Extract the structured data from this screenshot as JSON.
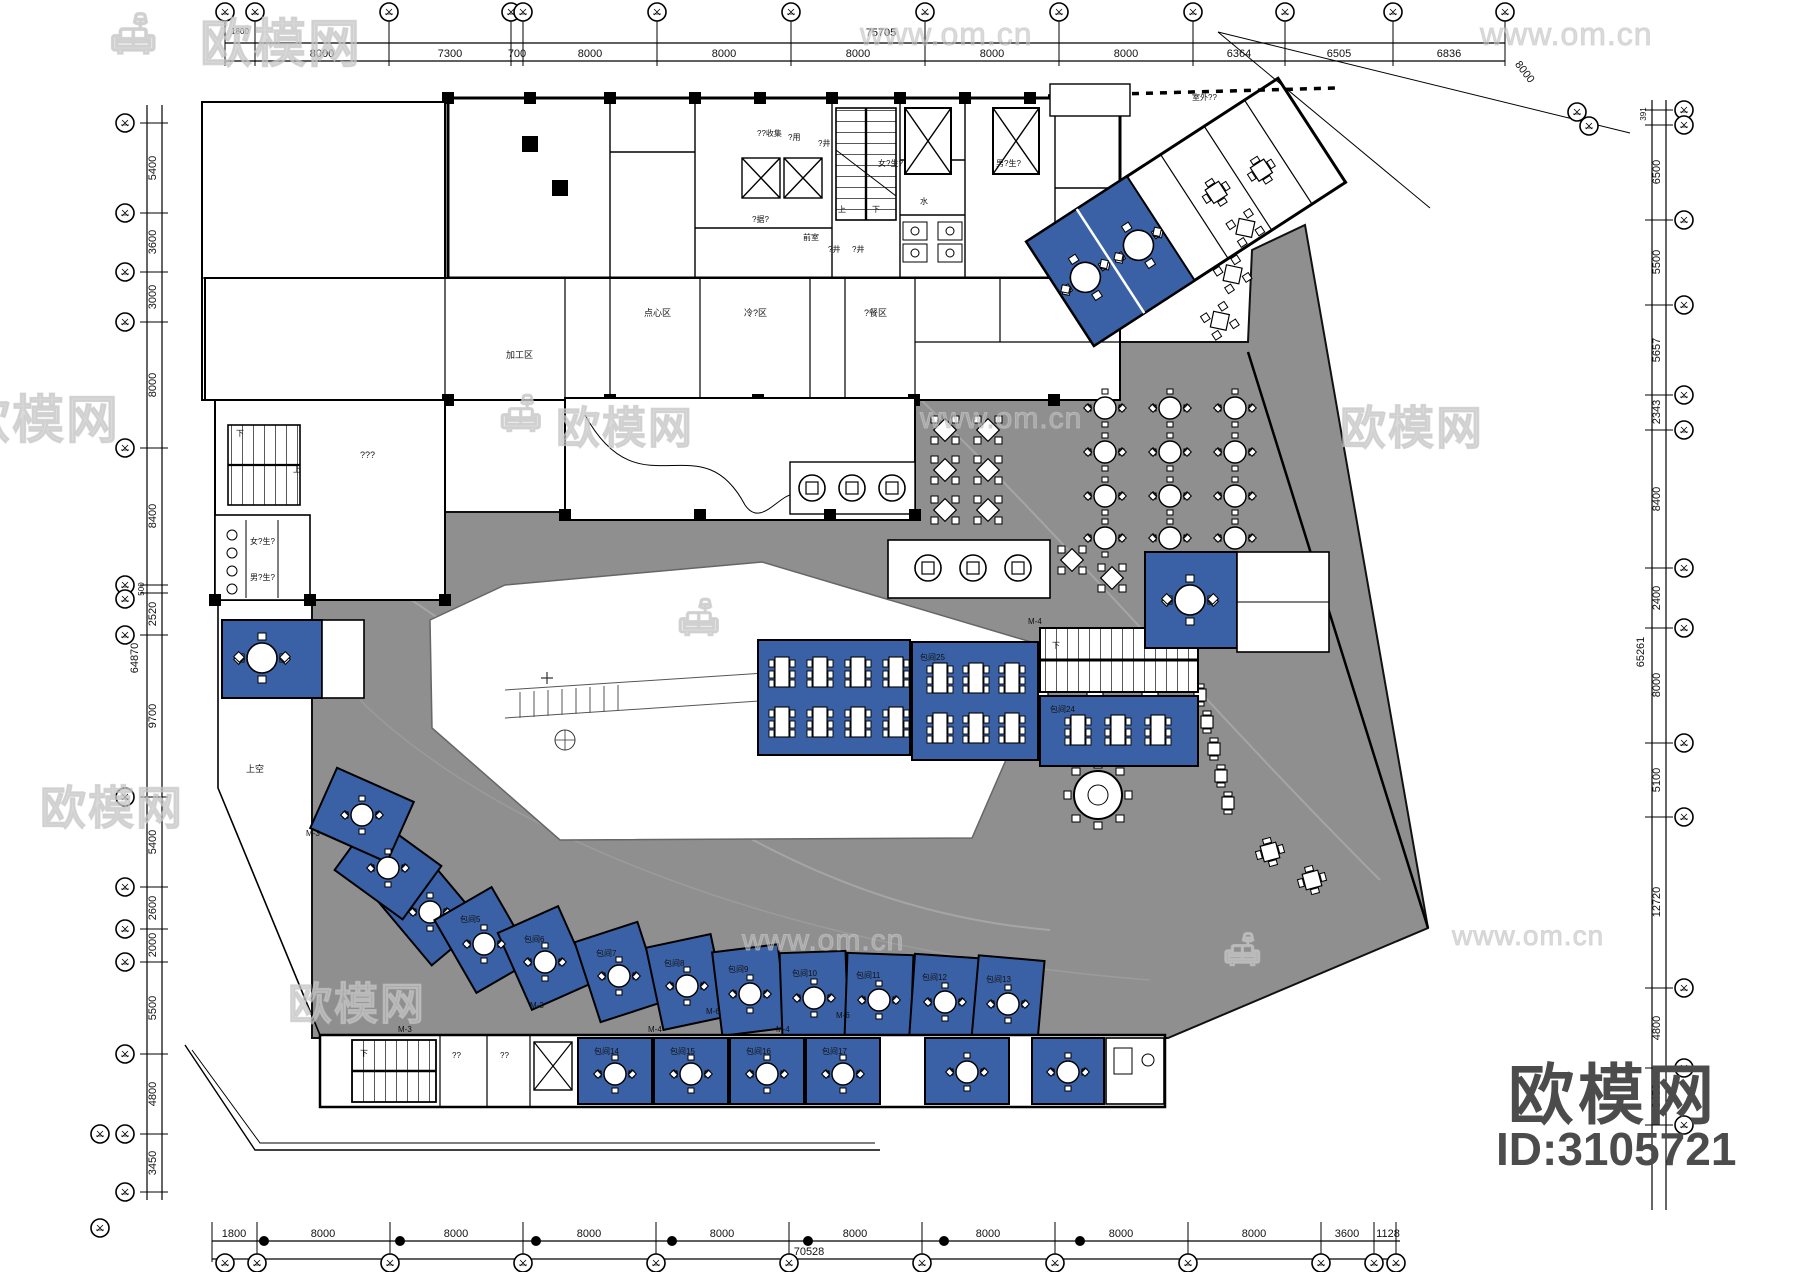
{
  "dims": {
    "top": {
      "pre": "1800",
      "labels": [
        "8000",
        "7300",
        "700",
        "8000",
        "8000",
        "8000",
        "8000",
        "8000",
        "6364",
        "6505",
        "6836"
      ],
      "total": "75705",
      "diagonal": "8000"
    },
    "bottom": {
      "labels": [
        "1800",
        "8000",
        "8000",
        "8000",
        "8000",
        "8000",
        "8000",
        "8000",
        "8000",
        "3600",
        "1128"
      ],
      "total": "70528"
    },
    "left": {
      "labels": [
        "5400",
        "3600",
        "3000",
        "8000",
        "8400",
        "500",
        "2520",
        "9700",
        "5400",
        "2600",
        "2000",
        "5500",
        "4800",
        "3450"
      ],
      "total": "64870"
    },
    "right": {
      "labels": [
        "391",
        "6500",
        "5500",
        "5657",
        "2343",
        "8400",
        "2400",
        "8000",
        "5100",
        "12720",
        "4800",
        "3450"
      ],
      "total": "65261"
    }
  },
  "watermark": {
    "brand": "欧模网",
    "site": "www.om.cn"
  },
  "footer": {
    "brand": "欧模网",
    "id": "ID:3105721"
  },
  "labels": {
    "collect": "??收集",
    "use": "?用",
    "shaft": "?井",
    "front_room": "前室",
    "up": "上",
    "down": "下",
    "water": "水",
    "female_wc": "女?生?",
    "male_wc": "男?生?",
    "storage": "?据?",
    "dessert": "点心区",
    "cold": "冷?区",
    "prep": "?餐区",
    "process": "加工区",
    "unknown": "???",
    "void": "上空",
    "outdoor": "室外??",
    "q2": "??"
  },
  "rooms": {
    "arc": [
      "包间5",
      "包间6",
      "包间7",
      "包间8",
      "包间9",
      "包间10",
      "包间11",
      "包间12",
      "包间13"
    ],
    "bottom": [
      "包间14",
      "包间15",
      "包间16",
      "包间17"
    ],
    "center_b": "包间25",
    "center_c": "包间24",
    "doors": {
      "m3": "M-3",
      "m4": "M-4",
      "m6": "M-6"
    }
  },
  "colors": {
    "room_blue": "#3a61a5",
    "floor_gray": "#8f8f8f",
    "wall_black": "#0a0a0a"
  }
}
